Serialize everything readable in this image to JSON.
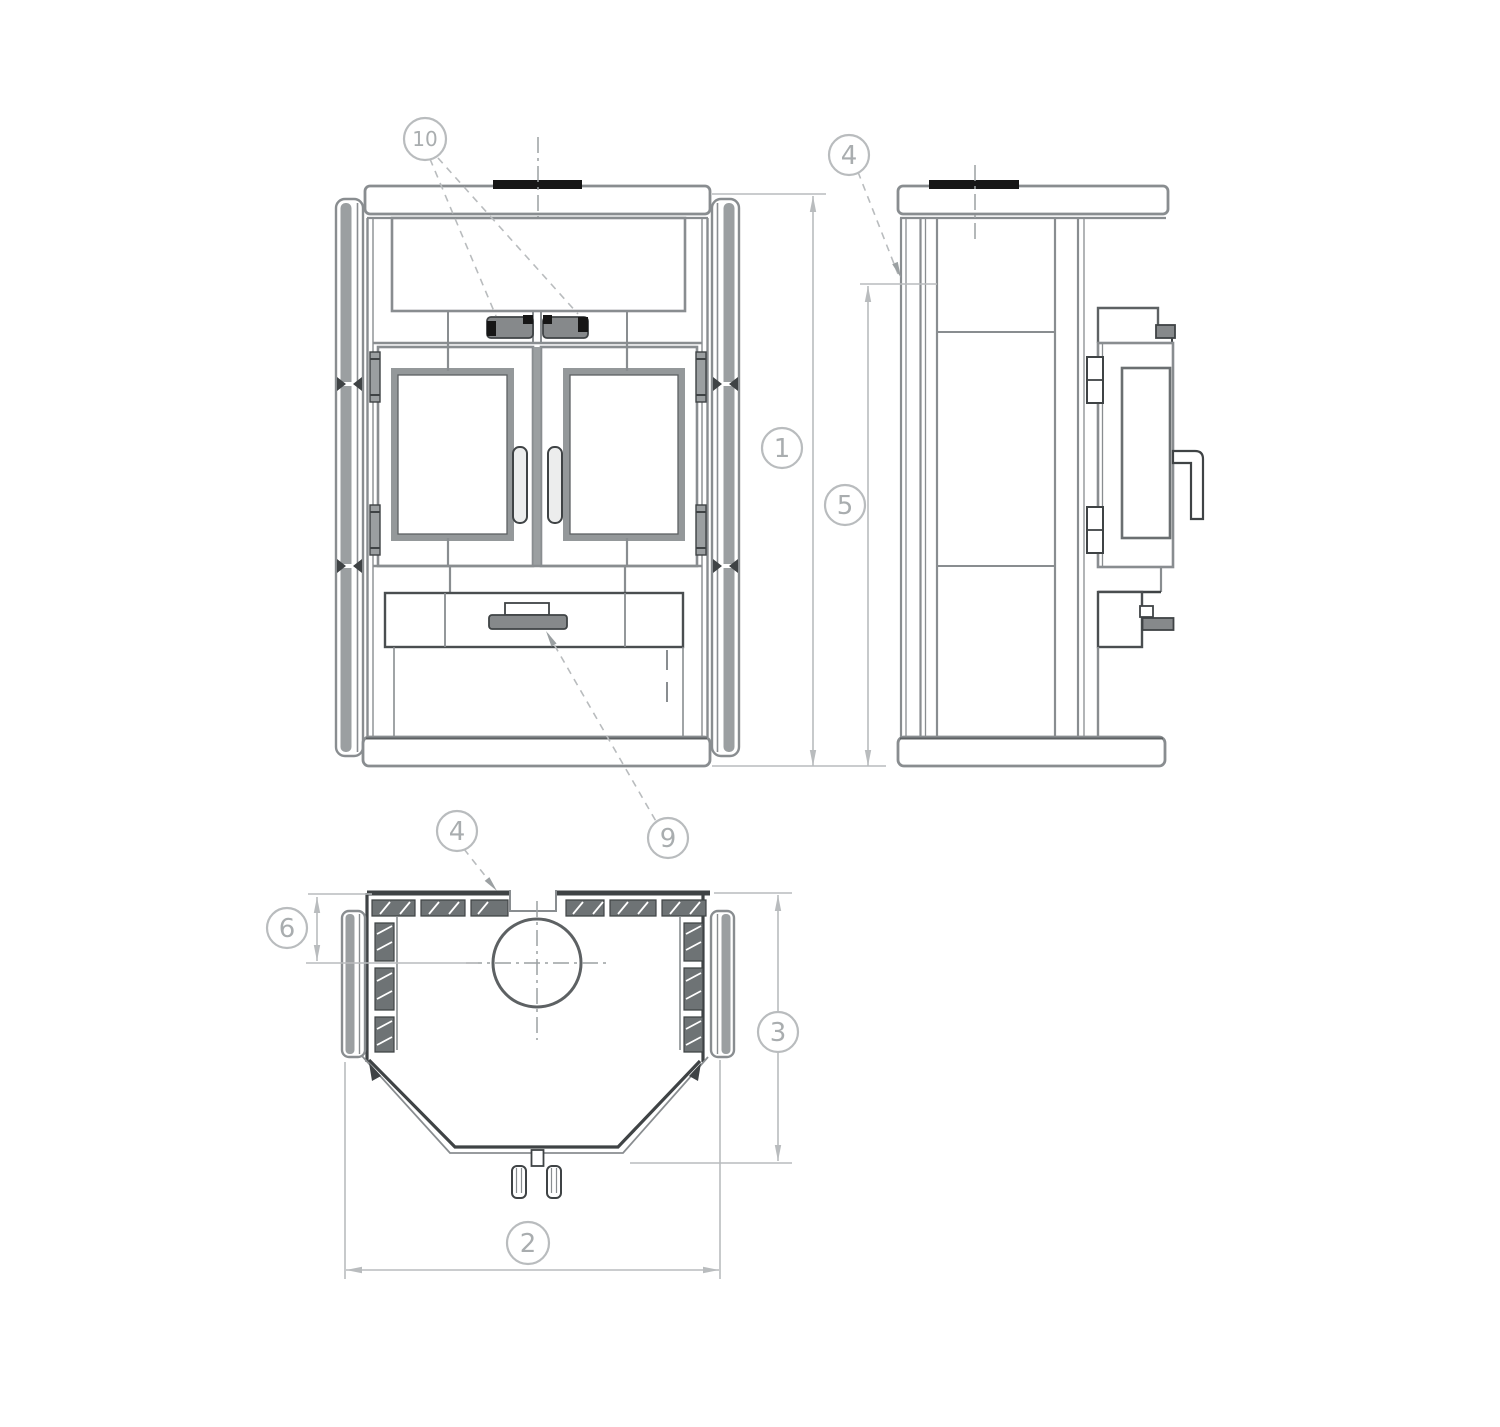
{
  "page": {
    "width": 1500,
    "height": 1427,
    "background": "#ffffff"
  },
  "colors": {
    "main_line": "#898d90",
    "dark_line": "#3f4345",
    "light_dim": "#b9bcbe",
    "callout_text": "#a9adaf",
    "black_fill": "#161616",
    "tile_fill": "#6e7375",
    "panel_gray": "#9b9fa1",
    "metal_gray": "#86898b"
  },
  "callouts": {
    "front_vents": {
      "label": "10"
    },
    "side_top_corner": {
      "label": "4"
    },
    "front_total_height": {
      "label": "1"
    },
    "side_body_height": {
      "label": "5"
    },
    "top_back_panel": {
      "label": "4"
    },
    "drawer_handle": {
      "label": "9"
    },
    "flue_offset": {
      "label": "6"
    },
    "top_depth": {
      "label": "3"
    },
    "top_width": {
      "label": "2"
    }
  }
}
